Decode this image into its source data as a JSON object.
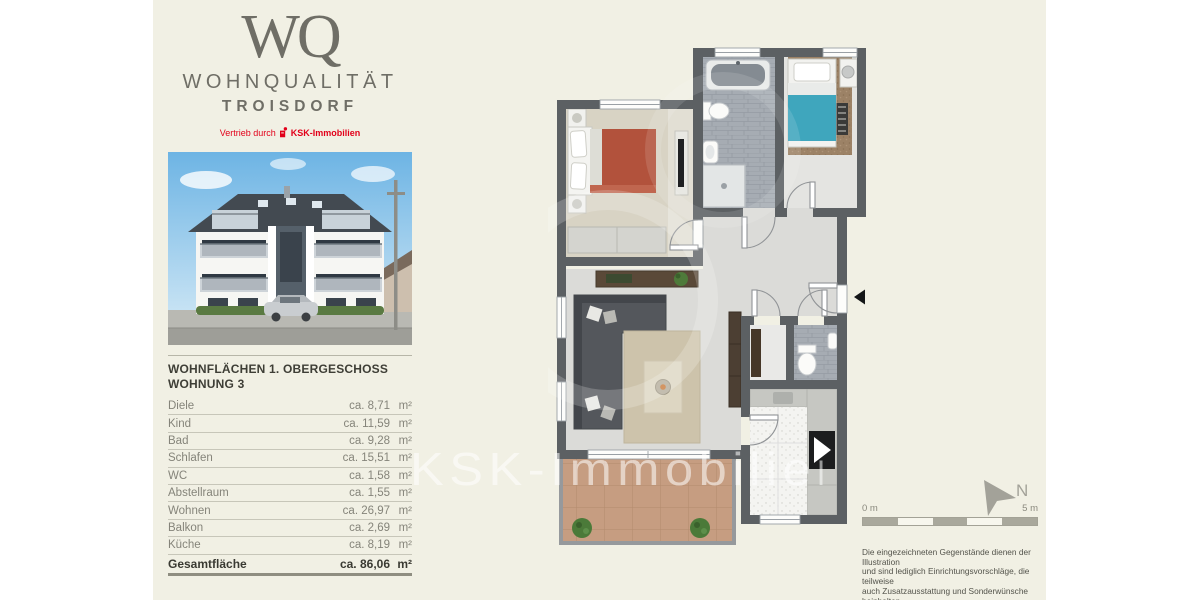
{
  "brand": {
    "monogram": "WQ",
    "name": "WOHNQUALITÄT",
    "city": "TROISDORF",
    "vertrieb_prefix": "Vertrieb durch",
    "distributor": "KSK-Immobilien",
    "accent_red": "#e2001a",
    "logo_color": "#6f6e66"
  },
  "area_table": {
    "title_line1": "WOHNFLÄCHEN 1. OBERGESCHOSS",
    "title_line2": "WOHNUNG 3",
    "rows": [
      {
        "label": "Diele",
        "value": "ca. 8,71",
        "unit": "m²"
      },
      {
        "label": "Kind",
        "value": "ca. 11,59",
        "unit": "m²"
      },
      {
        "label": "Bad",
        "value": "ca. 9,28",
        "unit": "m²"
      },
      {
        "label": "Schlafen",
        "value": "ca. 15,51",
        "unit": "m²"
      },
      {
        "label": "WC",
        "value": "ca. 1,58",
        "unit": "m²"
      },
      {
        "label": "Abstellraum",
        "value": "ca. 1,55",
        "unit": "m²"
      },
      {
        "label": "Wohnen",
        "value": "ca. 26,97",
        "unit": "m²"
      },
      {
        "label": "Balkon",
        "value": "ca. 2,69",
        "unit": "m²"
      },
      {
        "label": "Küche",
        "value": "ca. 8,19",
        "unit": "m²"
      }
    ],
    "total": {
      "label": "Gesamtfläche",
      "value": "ca. 86,06",
      "unit": "m²"
    }
  },
  "plan": {
    "watermark": "KSK-Immobilien",
    "north_label": "N",
    "scale_start": "0 m",
    "scale_end": "5 m",
    "wall_color": "#5c6063"
  },
  "disclaimer": {
    "line1": "Die eingezeichneten Gegenstände dienen der Illustration",
    "line2": "und sind lediglich Einrichtungsvorschläge, die teilweise",
    "line3": "auch Zusatzausstattung und Sonderwünsche beinhalten.",
    "line4": "Maßgeblich sind nur die Angaben im notariellen Kaufvertrag."
  }
}
